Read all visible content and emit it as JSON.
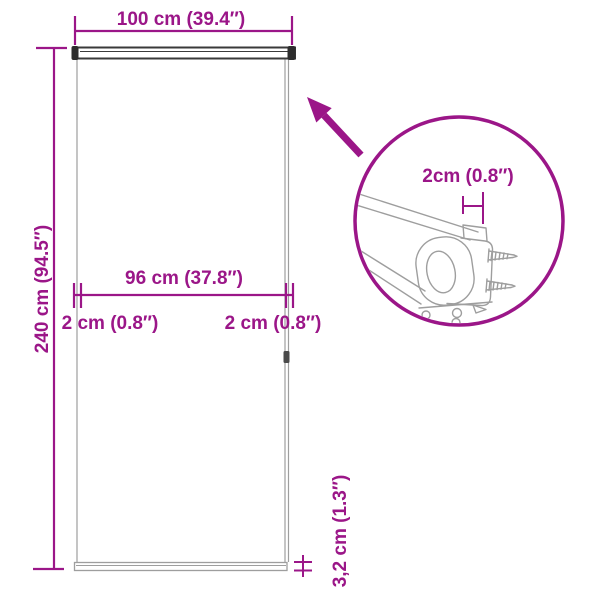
{
  "colors": {
    "accent": "#9B1688",
    "line_light": "#9e9e9e",
    "line_mid": "#8f8f8f",
    "line_dark": "#3a3a3a",
    "cap_fill": "#2d2d2d",
    "clip_fill": "#4a4a4a"
  },
  "labels": {
    "total_width": "100 cm (39.4″)",
    "total_height": "240 cm (94.5″)",
    "fabric_width": "96 cm (37.8″)",
    "gap_left": "2 cm (0.8″)",
    "gap_right": "2 cm (0.8″)",
    "bracket_gap": "2cm (0.8″)",
    "bottom_bar_height": "3,2 cm (1.3″)"
  }
}
